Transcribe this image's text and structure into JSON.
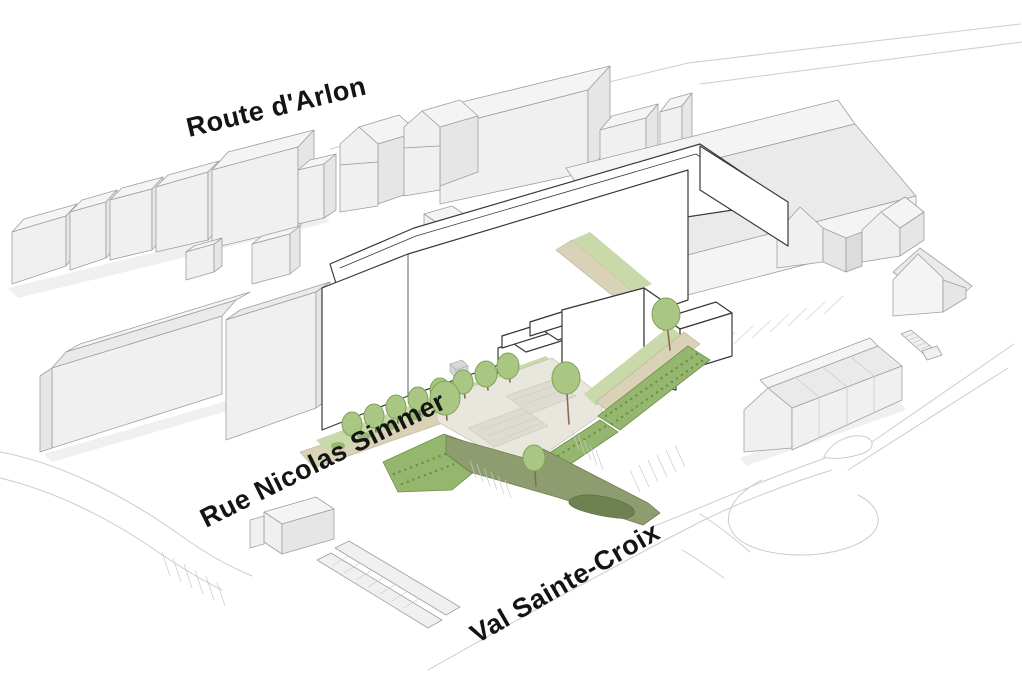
{
  "figure": {
    "kind": "axonometric-site-plan-illustration"
  },
  "street_labels": {
    "route_arlon": "Route d'Arlon",
    "rue_nicolas_simmer": "Rue Nicolas Simmer",
    "val_sainte_croix": "Val Sainte-Croix"
  },
  "palette": {
    "background": "#ffffff",
    "context_building_face": "#f0f0f0",
    "context_building_side": "#e6e6e6",
    "context_building_outline": "#9f9f9f",
    "proposed_fill": "#ffffff",
    "proposed_outline": "#3a3a3a",
    "tree_green": "#a9c783",
    "tree_green_dark": "#7fa257",
    "hedge_green": "#95b76d",
    "grass_green": "#c9d9a9",
    "path_tan": "#d9d2b6",
    "plaza_gray": "#e8e6dd",
    "ramp_olive": "#8d9d6f",
    "planting_olive_dark": "#6f8150",
    "road_line_gray": "#cccccc",
    "label_color": "#141414"
  }
}
